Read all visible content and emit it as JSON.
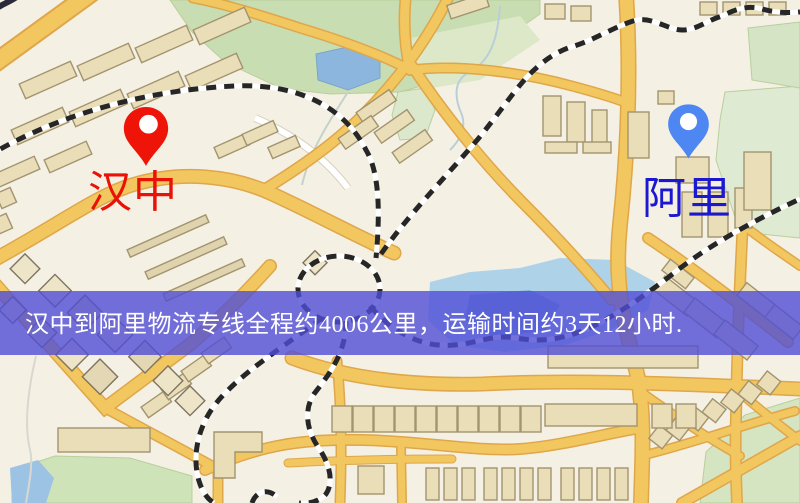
{
  "banner": {
    "text": "汉中到阿里物流专线全程约4006公里，运输时间约3天12小时.",
    "background_color": "#504dd6",
    "text_color": "#ffffff"
  },
  "markers": {
    "origin": {
      "label": "汉中",
      "pin_color": "#ee1508",
      "label_color": "#e81207"
    },
    "destination": {
      "label": "阿里",
      "pin_color": "#4e86f2",
      "label_color": "#1c18cf"
    }
  },
  "map": {
    "type": "street-map",
    "colors": {
      "background": "#f5f0e4",
      "road": "#f2c75f",
      "road_casing": "#dfa64a",
      "park": "#cde0b4",
      "water": "#9cc4e6",
      "railway": "#262626",
      "building": "#eadeb9"
    }
  }
}
